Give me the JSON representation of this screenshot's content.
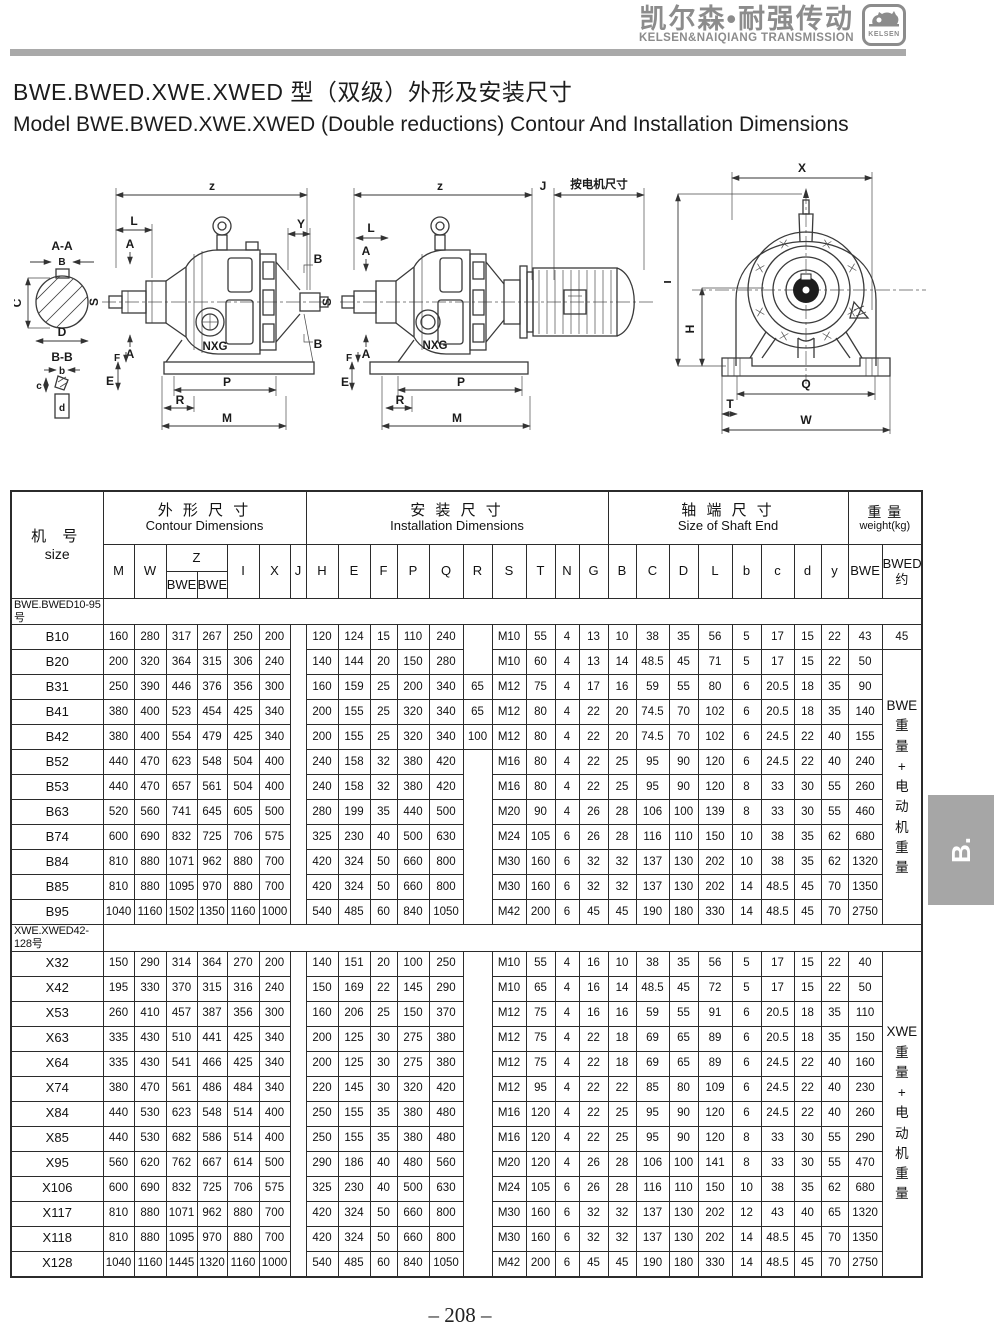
{
  "brand": {
    "cn": "凯尔森•耐强传动",
    "en": "KELSEN&NAIQIANG TRANSMISSION",
    "logo": "KELSEN"
  },
  "title": {
    "cn": "BWE.BWED.XWE.XWED 型（双级）外形及安装尺寸",
    "en": "Model BWE.BWED.XWE.XWED (Double reductions) Contour And Installation Dimensions"
  },
  "diagrams": {
    "left": {
      "labels": {
        "sec": "A-A",
        "b": "B",
        "c": "C",
        "d": "D",
        "s": "S",
        "s2": "S",
        "sec2": "B-B",
        "b2": "b",
        "c2": "c",
        "d2": "d",
        "z": "z",
        "l": "L",
        "a1": "A",
        "a2": "A",
        "y": "Y",
        "br1": "B",
        "br2": "B",
        "nxg": "NXG",
        "f": "F",
        "e": "E",
        "p": "P",
        "r": "R",
        "m": "M"
      }
    },
    "middle": {
      "labels": {
        "z": "z",
        "j": "J",
        "motor": "按电机尺寸",
        "l": "L",
        "a1": "A",
        "a2": "A",
        "nxg": "NXG",
        "f": "F",
        "e": "E",
        "p": "P",
        "r": "R",
        "m": "M"
      }
    },
    "right": {
      "labels": {
        "x": "X",
        "i": "I",
        "h": "H",
        "q": "Q",
        "t": "T",
        "w": "W"
      }
    }
  },
  "table": {
    "size_cn": "机 号",
    "size_en": "size",
    "groups": [
      {
        "cn": "外 形 尺 寸",
        "en": "Contour Dimensions"
      },
      {
        "cn": "安 装 尺 寸",
        "en": "Installation Dimensions"
      },
      {
        "cn": "轴 端 尺 寸",
        "en": "Size of Shaft End"
      },
      {
        "cn": "重 量",
        "en": "weight(kg)"
      }
    ],
    "z": "Z",
    "z_sub": [
      "BWE",
      "BWED"
    ],
    "letters1": [
      "M",
      "W"
    ],
    "letters2": [
      "I",
      "X",
      "J",
      "H",
      "E",
      "F",
      "P",
      "Q",
      "R",
      "S",
      "T",
      "N",
      "G",
      "B",
      "C",
      "D",
      "L",
      "b",
      "c",
      "d",
      "y"
    ],
    "w_bwe": "BWE",
    "w_bwed": "BWED\n约",
    "sections": [
      {
        "label": "BWE.BWED10-95号",
        "merged": {
          "start": 1,
          "span": 11,
          "text": "BWE\n重\n量\n+\n电\n动\n机\n重\n量"
        },
        "rows": [
          {
            "size": "B10",
            "bwed": "45",
            "cells": [
              "160",
              "280",
              "317",
              "267",
              "250",
              "200",
              "",
              "120",
              "124",
              "15",
              "110",
              "240",
              "",
              "M10",
              "55",
              "4",
              "13",
              "10",
              "38",
              "35",
              "56",
              "5",
              "17",
              "15",
              "22",
              "43"
            ]
          },
          {
            "size": "B20",
            "cells": [
              "200",
              "320",
              "364",
              "315",
              "306",
              "240",
              "",
              "140",
              "144",
              "20",
              "150",
              "280",
              "",
              "M10",
              "60",
              "4",
              "13",
              "14",
              "48.5",
              "45",
              "71",
              "5",
              "17",
              "15",
              "22",
              "50"
            ]
          },
          {
            "size": "B31",
            "cells": [
              "250",
              "390",
              "446",
              "376",
              "356",
              "300",
              "",
              "160",
              "159",
              "25",
              "200",
              "340",
              "65",
              "M12",
              "75",
              "4",
              "17",
              "16",
              "59",
              "55",
              "80",
              "6",
              "20.5",
              "18",
              "35",
              "90"
            ]
          },
          {
            "size": "B41",
            "cells": [
              "380",
              "400",
              "523",
              "454",
              "425",
              "340",
              "",
              "200",
              "155",
              "25",
              "320",
              "340",
              "65",
              "M12",
              "80",
              "4",
              "22",
              "20",
              "74.5",
              "70",
              "102",
              "6",
              "20.5",
              "18",
              "35",
              "140"
            ]
          },
          {
            "size": "B42",
            "cells": [
              "380",
              "400",
              "554",
              "479",
              "425",
              "340",
              "",
              "200",
              "155",
              "25",
              "320",
              "340",
              "100",
              "M12",
              "80",
              "4",
              "22",
              "20",
              "74.5",
              "70",
              "102",
              "6",
              "24.5",
              "22",
              "40",
              "155"
            ]
          },
          {
            "size": "B52",
            "cells": [
              "440",
              "470",
              "623",
              "548",
              "504",
              "400",
              "",
              "240",
              "158",
              "32",
              "380",
              "420",
              "",
              "M16",
              "80",
              "4",
              "22",
              "25",
              "95",
              "90",
              "120",
              "6",
              "24.5",
              "22",
              "40",
              "240"
            ]
          },
          {
            "size": "B53",
            "cells": [
              "440",
              "470",
              "657",
              "561",
              "504",
              "400",
              "",
              "240",
              "158",
              "32",
              "380",
              "420",
              "",
              "M16",
              "80",
              "4",
              "22",
              "25",
              "95",
              "90",
              "120",
              "8",
              "33",
              "30",
              "55",
              "260"
            ]
          },
          {
            "size": "B63",
            "cells": [
              "520",
              "560",
              "741",
              "645",
              "605",
              "500",
              "",
              "280",
              "199",
              "35",
              "440",
              "500",
              "",
              "M20",
              "90",
              "4",
              "26",
              "28",
              "106",
              "100",
              "139",
              "8",
              "33",
              "30",
              "55",
              "460"
            ]
          },
          {
            "size": "B74",
            "cells": [
              "600",
              "690",
              "832",
              "725",
              "706",
              "575",
              "",
              "325",
              "230",
              "40",
              "500",
              "630",
              "",
              "M24",
              "105",
              "6",
              "26",
              "28",
              "116",
              "110",
              "150",
              "10",
              "38",
              "35",
              "62",
              "680"
            ]
          },
          {
            "size": "B84",
            "cells": [
              "810",
              "880",
              "1071",
              "962",
              "880",
              "700",
              "",
              "420",
              "324",
              "50",
              "660",
              "800",
              "",
              "M30",
              "160",
              "6",
              "32",
              "32",
              "137",
              "130",
              "202",
              "10",
              "38",
              "35",
              "62",
              "1320"
            ]
          },
          {
            "size": "B85",
            "cells": [
              "810",
              "880",
              "1095",
              "970",
              "880",
              "700",
              "",
              "420",
              "324",
              "50",
              "660",
              "800",
              "",
              "M30",
              "160",
              "6",
              "32",
              "32",
              "137",
              "130",
              "202",
              "14",
              "48.5",
              "45",
              "70",
              "1350"
            ]
          },
          {
            "size": "B95",
            "cells": [
              "1040",
              "1160",
              "1502",
              "1350",
              "1160",
              "1000",
              "",
              "540",
              "485",
              "60",
              "840",
              "1050",
              "",
              "M42",
              "200",
              "6",
              "45",
              "45",
              "190",
              "180",
              "330",
              "14",
              "48.5",
              "45",
              "70",
              "2750"
            ]
          }
        ]
      },
      {
        "label": "XWE.XWED42-128号",
        "merged": {
          "start": 0,
          "span": 13,
          "text": "XWE\n重\n量\n+\n电\n动\n机\n重\n量"
        },
        "rows": [
          {
            "size": "X32",
            "cells": [
              "150",
              "290",
              "314",
              "364",
              "270",
              "200",
              "",
              "140",
              "151",
              "20",
              "100",
              "250",
              "",
              "M10",
              "55",
              "4",
              "16",
              "10",
              "38",
              "35",
              "56",
              "5",
              "17",
              "15",
              "22",
              "40"
            ]
          },
          {
            "size": "X42",
            "cells": [
              "195",
              "330",
              "370",
              "315",
              "316",
              "240",
              "",
              "150",
              "169",
              "22",
              "145",
              "290",
              "",
              "M10",
              "65",
              "4",
              "16",
              "14",
              "48.5",
              "45",
              "72",
              "5",
              "17",
              "15",
              "22",
              "50"
            ]
          },
          {
            "size": "X53",
            "cells": [
              "260",
              "410",
              "457",
              "387",
              "356",
              "300",
              "",
              "160",
              "206",
              "25",
              "150",
              "370",
              "",
              "M12",
              "75",
              "4",
              "16",
              "16",
              "59",
              "55",
              "91",
              "6",
              "20.5",
              "18",
              "35",
              "110"
            ]
          },
          {
            "size": "X63",
            "cells": [
              "335",
              "430",
              "510",
              "441",
              "425",
              "340",
              "",
              "200",
              "125",
              "30",
              "275",
              "380",
              "",
              "M12",
              "75",
              "4",
              "22",
              "18",
              "69",
              "65",
              "89",
              "6",
              "20.5",
              "18",
              "35",
              "150"
            ]
          },
          {
            "size": "X64",
            "cells": [
              "335",
              "430",
              "541",
              "466",
              "425",
              "340",
              "",
              "200",
              "125",
              "30",
              "275",
              "380",
              "",
              "M12",
              "75",
              "4",
              "22",
              "18",
              "69",
              "65",
              "89",
              "6",
              "24.5",
              "22",
              "40",
              "160"
            ]
          },
          {
            "size": "X74",
            "cells": [
              "380",
              "470",
              "561",
              "486",
              "484",
              "340",
              "",
              "220",
              "145",
              "30",
              "320",
              "420",
              "",
              "M12",
              "95",
              "4",
              "22",
              "22",
              "85",
              "80",
              "109",
              "6",
              "24.5",
              "22",
              "40",
              "230"
            ]
          },
          {
            "size": "X84",
            "cells": [
              "440",
              "530",
              "623",
              "548",
              "514",
              "400",
              "",
              "250",
              "155",
              "35",
              "380",
              "480",
              "",
              "M16",
              "120",
              "4",
              "22",
              "25",
              "95",
              "90",
              "120",
              "6",
              "24.5",
              "22",
              "40",
              "260"
            ]
          },
          {
            "size": "X85",
            "cells": [
              "440",
              "530",
              "682",
              "586",
              "514",
              "400",
              "",
              "250",
              "155",
              "35",
              "380",
              "480",
              "",
              "M16",
              "120",
              "4",
              "22",
              "25",
              "95",
              "90",
              "120",
              "8",
              "33",
              "30",
              "55",
              "290"
            ]
          },
          {
            "size": "X95",
            "cells": [
              "560",
              "620",
              "762",
              "667",
              "614",
              "500",
              "",
              "290",
              "186",
              "40",
              "480",
              "560",
              "",
              "M20",
              "120",
              "4",
              "26",
              "28",
              "106",
              "100",
              "141",
              "8",
              "33",
              "30",
              "55",
              "470"
            ]
          },
          {
            "size": "X106",
            "cells": [
              "600",
              "690",
              "832",
              "725",
              "706",
              "575",
              "",
              "325",
              "230",
              "40",
              "500",
              "630",
              "",
              "M24",
              "105",
              "6",
              "26",
              "28",
              "116",
              "110",
              "150",
              "10",
              "38",
              "35",
              "62",
              "680"
            ]
          },
          {
            "size": "X117",
            "cells": [
              "810",
              "880",
              "1071",
              "962",
              "880",
              "700",
              "",
              "420",
              "324",
              "50",
              "660",
              "800",
              "",
              "M30",
              "160",
              "6",
              "32",
              "32",
              "137",
              "130",
              "202",
              "12",
              "43",
              "40",
              "65",
              "1320"
            ]
          },
          {
            "size": "X118",
            "cells": [
              "810",
              "880",
              "1095",
              "970",
              "880",
              "700",
              "",
              "420",
              "324",
              "50",
              "660",
              "800",
              "",
              "M30",
              "160",
              "6",
              "32",
              "32",
              "137",
              "130",
              "202",
              "14",
              "48.5",
              "45",
              "70",
              "1350"
            ]
          },
          {
            "size": "X128",
            "cells": [
              "1040",
              "1160",
              "1445",
              "1320",
              "1160",
              "1000",
              "",
              "540",
              "485",
              "60",
              "840",
              "1050",
              "",
              "M42",
              "200",
              "6",
              "45",
              "45",
              "190",
              "180",
              "330",
              "14",
              "48.5",
              "45",
              "70",
              "2750"
            ]
          }
        ]
      }
    ]
  },
  "side_tab": "B.",
  "page_number": "– 208 –",
  "colors": {
    "brand_gray": "#8c8c8c",
    "bar_gray": "#a9a9a9",
    "tab_gray": "#a6a6a6",
    "line": "#2b2b2b"
  }
}
